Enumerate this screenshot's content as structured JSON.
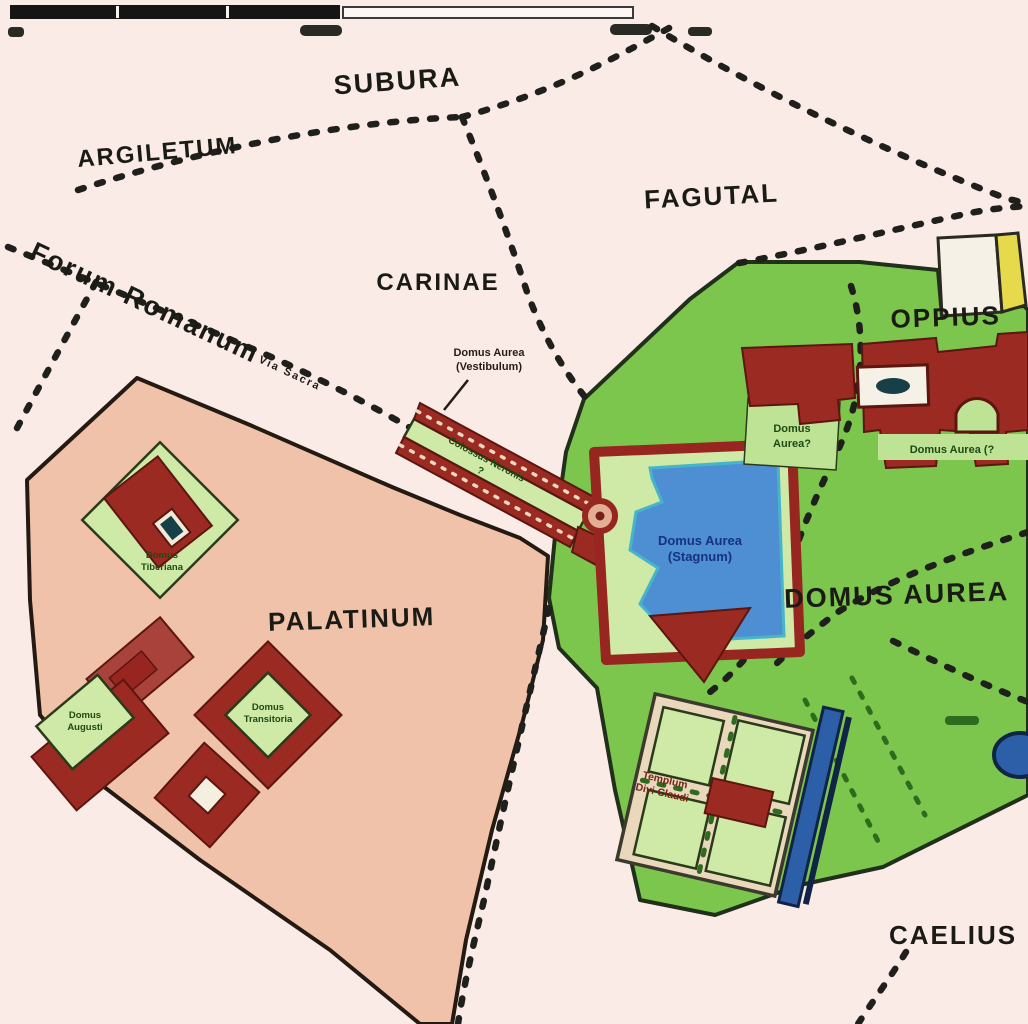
{
  "map_title": "Schematic map of the Domus Aurea area of ancient Rome",
  "colors": {
    "background": "#fbebe7",
    "palatine_fill": "#f1c2aa",
    "palatine_stroke": "#241a12",
    "park_fill": "#7cc64e",
    "park_stroke": "#20301a",
    "courtyard_fill": "#cfe9a6",
    "building_fill": "#9b2a23",
    "building_stroke": "#5c150f",
    "lake_fill": "#4e8ed3",
    "lake_edge": "#47b5c9",
    "lake_label": "#16337f",
    "nymphaeum_fill": "#2d5fa8",
    "nymphaeum_stroke": "#102445",
    "platform_fill": "#e9d8bc",
    "road": "#1f1f1c",
    "garden_path": "#2e6b1d",
    "yellow_area": "#e6d94b",
    "white_building": "#f6f1e6",
    "region_label": "#1b1b16",
    "green_label": "#1d4a14",
    "temple_label": "#7a2217"
  },
  "region_labels": {
    "subura": "SUBURA",
    "argiletum": "ARGILETUM",
    "fagutal": "FAGUTAL",
    "carinae": "CARINAE",
    "forum_romanum": "Forum Romanum",
    "via_sacra": "Via Sacra",
    "oppius": "OPPIUS",
    "domus_aurea": "DOMUS AUREA",
    "palatinum": "PALATINUM",
    "caelius": "CAELIUS"
  },
  "site_labels": {
    "vestibulum_line1": "Domus Aurea",
    "vestibulum_line2": "(Vestibulum)",
    "colossus_line1": "Colossus Neronis",
    "colossus_line2": "?",
    "stagnum_line1": "Domus Aurea",
    "stagnum_line2": "(Stagnum)",
    "oppius_west_line1": "Domus",
    "oppius_west_line2": "Aurea?",
    "oppius_east": "Domus Aurea (?",
    "palatine_north_line1": "Domus",
    "palatine_north_line2": "Tiberiana",
    "palatine_west_line1": "Domus",
    "palatine_west_line2": "Augusti",
    "palatine_east_line1": "Domus",
    "palatine_east_line2": "Transitoria",
    "templum_line1": "Templum",
    "templum_line2": "Divi Claudi"
  }
}
